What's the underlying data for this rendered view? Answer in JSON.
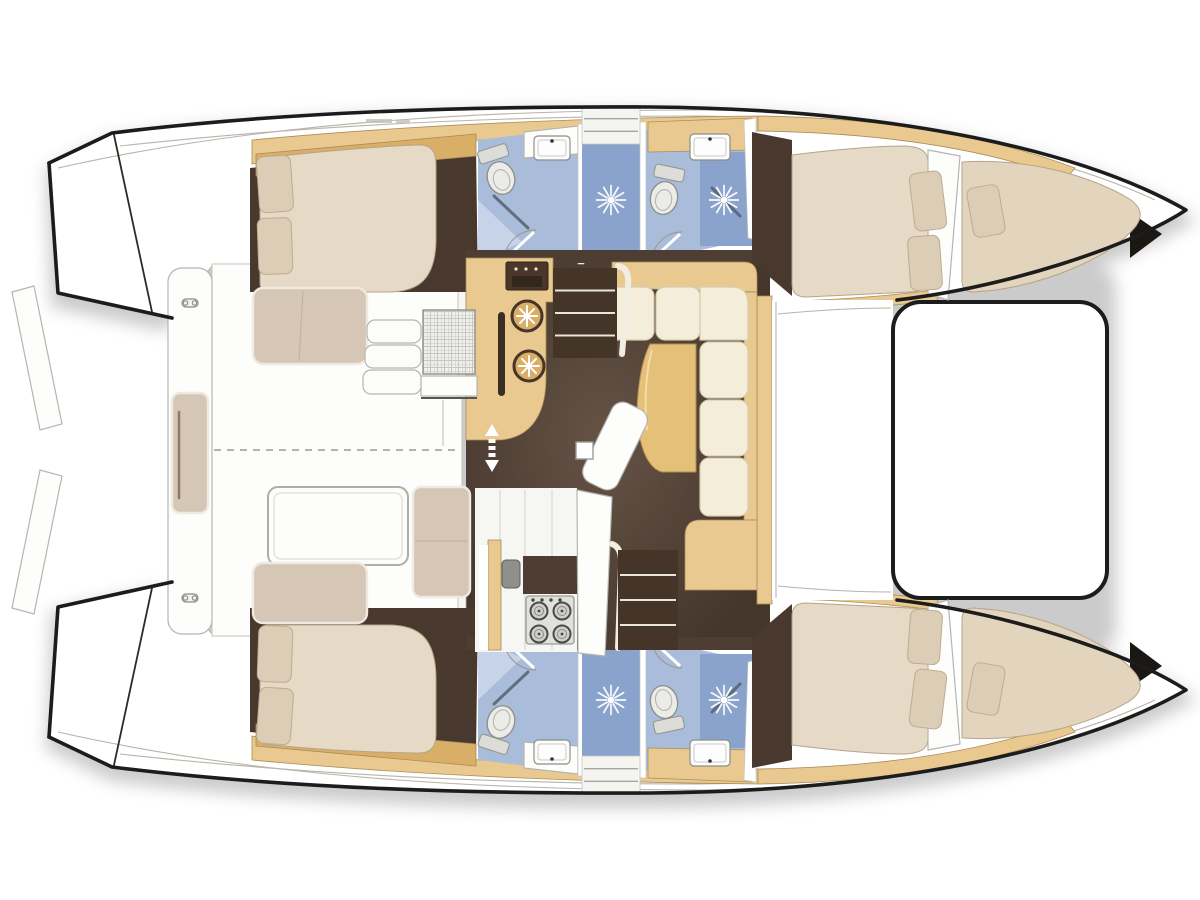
{
  "meta": {
    "title": "Catamaran deck and accommodation floor plan",
    "diagram_type": "top-view yacht layout",
    "orientation": {
      "bow": "right",
      "stern": "left"
    },
    "summary": {
      "cabins": 4,
      "wet_rooms": 4,
      "shower_stalls": 2,
      "bow_berths": 2
    }
  },
  "palette": {
    "outline": "#1c1c1c",
    "line": "#b9b3a9",
    "wood": "#e9c98f",
    "woodEdge": "#aa8d58",
    "woodDeep": "#d9ae67",
    "floorSaloon": "#4e3d32",
    "floorCabin": "#49382d",
    "mattress": "#e6d9c5",
    "mattressEdge": "#b5a48a",
    "pillow": "#dccdb7",
    "pillowEdge": "#bfab90",
    "cream": "#f4edda",
    "creamEdge": "#d6cbad",
    "cushion": "#d6c6b5",
    "cushionEdge": "#b6a592",
    "tableWood": "#e5c079",
    "tableEdge": "#af8a4e",
    "blue": "#a9bcd9",
    "blueDark": "#8aa3cc",
    "blueLight": "#c6d3e8",
    "white": "#fdfdfb",
    "steel": "#8f8f8b",
    "stove": "#e0e0dc"
  },
  "areas": [
    {
      "id": "cockpit",
      "name": "aft cockpit with table and bench"
    },
    {
      "id": "transom-bench",
      "name": "aft crossbeam bench with cushion and cleats"
    },
    {
      "id": "helm-seat",
      "name": "raised helm bench with woven seat and access steps"
    },
    {
      "id": "saloon",
      "name": "bridgedeck saloon"
    },
    {
      "id": "galley",
      "name": "galley: oven, twin cool-box hatches, sink, 4-burner stove"
    },
    {
      "id": "dinette",
      "name": "L-shaped settee with table"
    },
    {
      "id": "chaise",
      "name": "chart / chaise seat"
    },
    {
      "id": "port-aft-cabin",
      "name": "port aft double cabin"
    },
    {
      "id": "port-aft-head",
      "name": "port aft head"
    },
    {
      "id": "port-shower",
      "name": "port shower stall"
    },
    {
      "id": "port-fwd-head",
      "name": "port forward head"
    },
    {
      "id": "port-fwd-cabin",
      "name": "port forward double cabin"
    },
    {
      "id": "port-bow-berth",
      "name": "port forepeak berth"
    },
    {
      "id": "stbd-aft-cabin",
      "name": "starboard aft double cabin"
    },
    {
      "id": "stbd-aft-head",
      "name": "starboard aft head"
    },
    {
      "id": "stbd-shower",
      "name": "starboard shower stall"
    },
    {
      "id": "stbd-fwd-head",
      "name": "starboard forward head"
    },
    {
      "id": "stbd-fwd-cabin",
      "name": "starboard forward double cabin"
    },
    {
      "id": "stbd-bow-berth",
      "name": "starboard forepeak berth"
    },
    {
      "id": "trampoline",
      "name": "bow trampoline"
    },
    {
      "id": "foredeck",
      "name": "forward crossdeck"
    }
  ],
  "fixtures": {
    "shower_roses": [
      {
        "x": 611,
        "y": 200
      },
      {
        "x": 724,
        "y": 200
      },
      {
        "x": 611,
        "y": 700
      },
      {
        "x": 724,
        "y": 700
      }
    ],
    "fridge_hatches": [
      {
        "x": 527,
        "y": 316,
        "r": 15
      },
      {
        "x": 529,
        "y": 366,
        "r": 15
      }
    ],
    "stove": {
      "x": 526,
      "y": 596,
      "w": 48,
      "h": 48,
      "burners": [
        [
          539,
          611
        ],
        [
          562,
          611
        ],
        [
          539,
          634
        ],
        [
          562,
          634
        ]
      ],
      "knobs": [
        [
          533,
          600
        ],
        [
          542,
          600
        ],
        [
          551,
          600
        ],
        [
          560,
          600
        ]
      ]
    },
    "sinks": [
      {
        "x": 534,
        "y": 136,
        "w": 36,
        "h": 24,
        "faucet": "top"
      },
      {
        "x": 690,
        "y": 134,
        "w": 40,
        "h": 26,
        "faucet": "top"
      },
      {
        "x": 534,
        "y": 740,
        "w": 36,
        "h": 24,
        "faucet": "bottom"
      },
      {
        "x": 690,
        "y": 740,
        "w": 40,
        "h": 26,
        "faucet": "bottom"
      }
    ],
    "toilets": [
      {
        "x": 501,
        "y": 178,
        "rot": -18,
        "tank": "top"
      },
      {
        "x": 664,
        "y": 198,
        "rot": 12,
        "tank": "top"
      },
      {
        "x": 501,
        "y": 722,
        "rot": 18,
        "tank": "bottom"
      },
      {
        "x": 664,
        "y": 702,
        "rot": -12,
        "tank": "bottom"
      }
    ],
    "pillows": [
      {
        "x": 258,
        "y": 156,
        "w": 34,
        "h": 56,
        "r": -4
      },
      {
        "x": 258,
        "y": 218,
        "w": 34,
        "h": 56,
        "r": -2
      },
      {
        "x": 258,
        "y": 688,
        "w": 34,
        "h": 56,
        "r": 4
      },
      {
        "x": 258,
        "y": 626,
        "w": 34,
        "h": 56,
        "r": 2
      },
      {
        "x": 912,
        "y": 172,
        "w": 32,
        "h": 58,
        "r": -7
      },
      {
        "x": 909,
        "y": 236,
        "w": 32,
        "h": 54,
        "r": -4
      },
      {
        "x": 912,
        "y": 670,
        "w": 32,
        "h": 58,
        "r": 7
      },
      {
        "x": 909,
        "y": 610,
        "w": 32,
        "h": 54,
        "r": 4
      },
      {
        "x": 970,
        "y": 186,
        "w": 32,
        "h": 50,
        "r": -10
      },
      {
        "x": 970,
        "y": 664,
        "w": 32,
        "h": 50,
        "r": 10
      }
    ],
    "cleats": [
      {
        "x": 190,
        "y": 303
      },
      {
        "x": 190,
        "y": 598
      }
    ],
    "stair_flights": [
      {
        "x": 553,
        "y": 268,
        "w": 64,
        "h": 90,
        "n": 3,
        "light": false
      },
      {
        "x": 618,
        "y": 550,
        "w": 60,
        "h": 100,
        "n": 3,
        "light": false
      },
      {
        "x": 582,
        "y": 106,
        "w": 58,
        "h": 38,
        "n": 2,
        "light": true
      },
      {
        "x": 582,
        "y": 756,
        "w": 58,
        "h": 38,
        "n": 2,
        "light": true
      }
    ],
    "cockpit_steps": [
      {
        "x": 367,
        "y": 320,
        "w": 54,
        "h": 23
      },
      {
        "x": 365,
        "y": 345,
        "w": 56,
        "h": 23
      },
      {
        "x": 363,
        "y": 370,
        "w": 58,
        "h": 24
      }
    ],
    "mast_post": {
      "x": 576,
      "y": 442,
      "w": 17,
      "h": 17
    },
    "door_arrows": {
      "cx": 492,
      "top": 424,
      "bottom": 472
    },
    "deck_marks": [
      {
        "x": 366,
        "y": 119,
        "w": 26,
        "h": 4
      },
      {
        "x": 396,
        "y": 120,
        "w": 14,
        "h": 3
      }
    ]
  }
}
